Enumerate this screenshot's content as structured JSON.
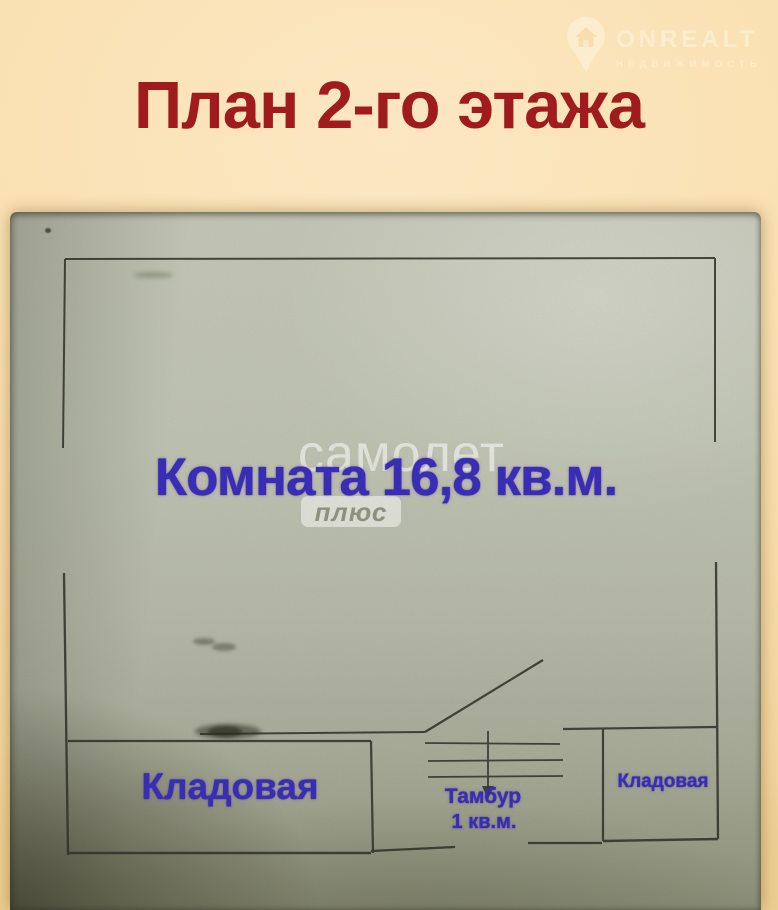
{
  "page": {
    "title": "План 2-го этажа"
  },
  "watermarks": {
    "onrealt": {
      "brand": "ONREALT",
      "tagline": "НЕДВИЖИМОСТЬ",
      "icon": "map-pin-house-icon"
    },
    "samolet": {
      "line1": "самолет",
      "line2": "плюс"
    }
  },
  "floor_plan": {
    "room": {
      "label": "Комната 16,8 кв.м."
    },
    "storage_left": {
      "label": "Кладовая"
    },
    "storage_right": {
      "label": "Кладовая"
    },
    "vestibule": {
      "label": "Тамбур",
      "area": "1 кв.м."
    }
  },
  "colors": {
    "title_red": "#a01c1c",
    "label_blue": "#382db6",
    "paper_sage": "#b8bcaa",
    "background_cream": "#f9dfae",
    "plan_line": "#32322a"
  }
}
